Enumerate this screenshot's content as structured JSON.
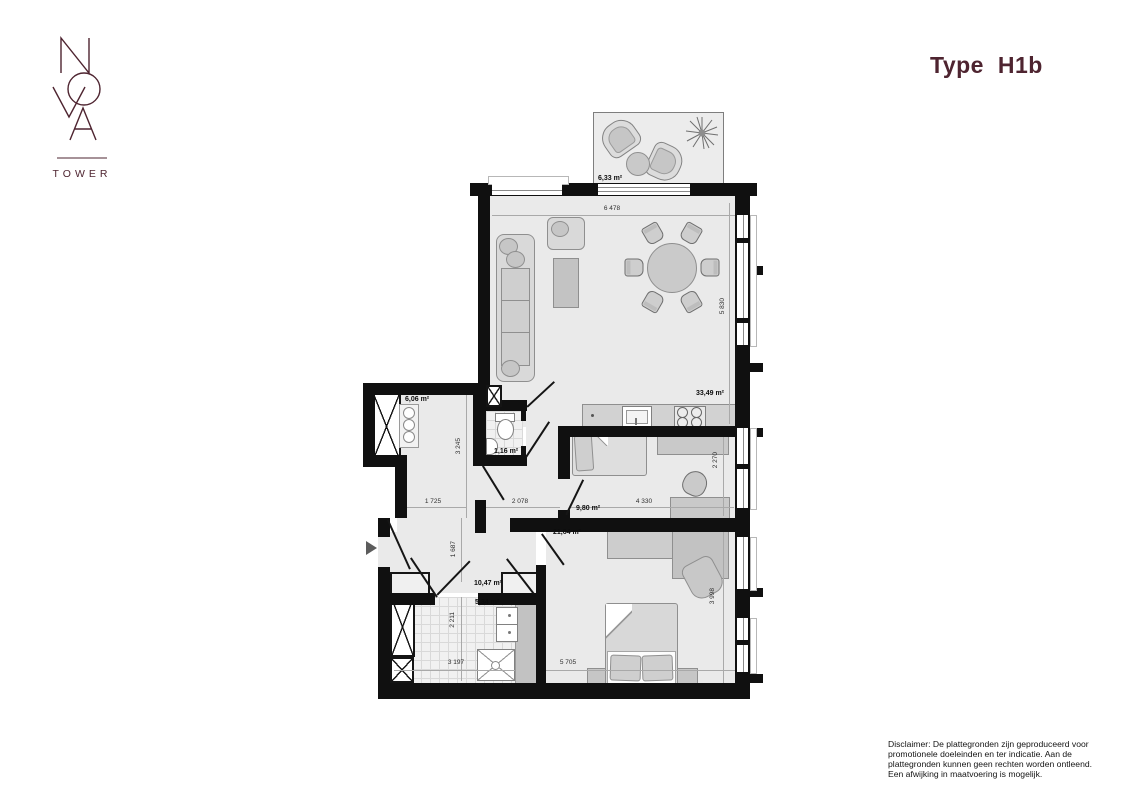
{
  "page": {
    "background": "#ffffff"
  },
  "logo": {
    "name": "NOVA",
    "subtitle": "TOWER",
    "color": "#4e2430"
  },
  "header": {
    "title": "Type H1b",
    "color": "#4e2430"
  },
  "floorplan": {
    "areas": {
      "balcony": "6,33 m²",
      "living": "33,49 m²",
      "storage": "6,06 m²",
      "toilet": "1,16 m²",
      "bedroom_small": "9,80 m²",
      "hall": "10,47 m²",
      "bathroom": "5,34 m²",
      "bedroom_master": "21,64 m²"
    },
    "dims": {
      "living_width": "6 478",
      "living_height": "5 830",
      "storage_height": "3 245",
      "storage_width": "1 725",
      "corridor_width": "2 078",
      "bedroom_small_width": "4 330",
      "bedroom_small_height": "2 270",
      "hall_height": "1 687",
      "bathroom_height": "2 211",
      "bathroom_width": "3 197",
      "bedroom_master_width": "5 705",
      "bedroom_master_height": "3 998"
    },
    "colors": {
      "wall": "#101010",
      "floor": "#eaeaea",
      "furniture": "#cdcdcd"
    }
  },
  "disclaimer": {
    "line1": "Disclaimer: De plattegronden zijn geproduceerd voor",
    "line2": "promotionele doeleinden en ter indicatie. Aan de",
    "line3": "plattegronden kunnen geen rechten worden ontleend.",
    "line4": "Een afwijking in maatvoering is mogelijk."
  }
}
